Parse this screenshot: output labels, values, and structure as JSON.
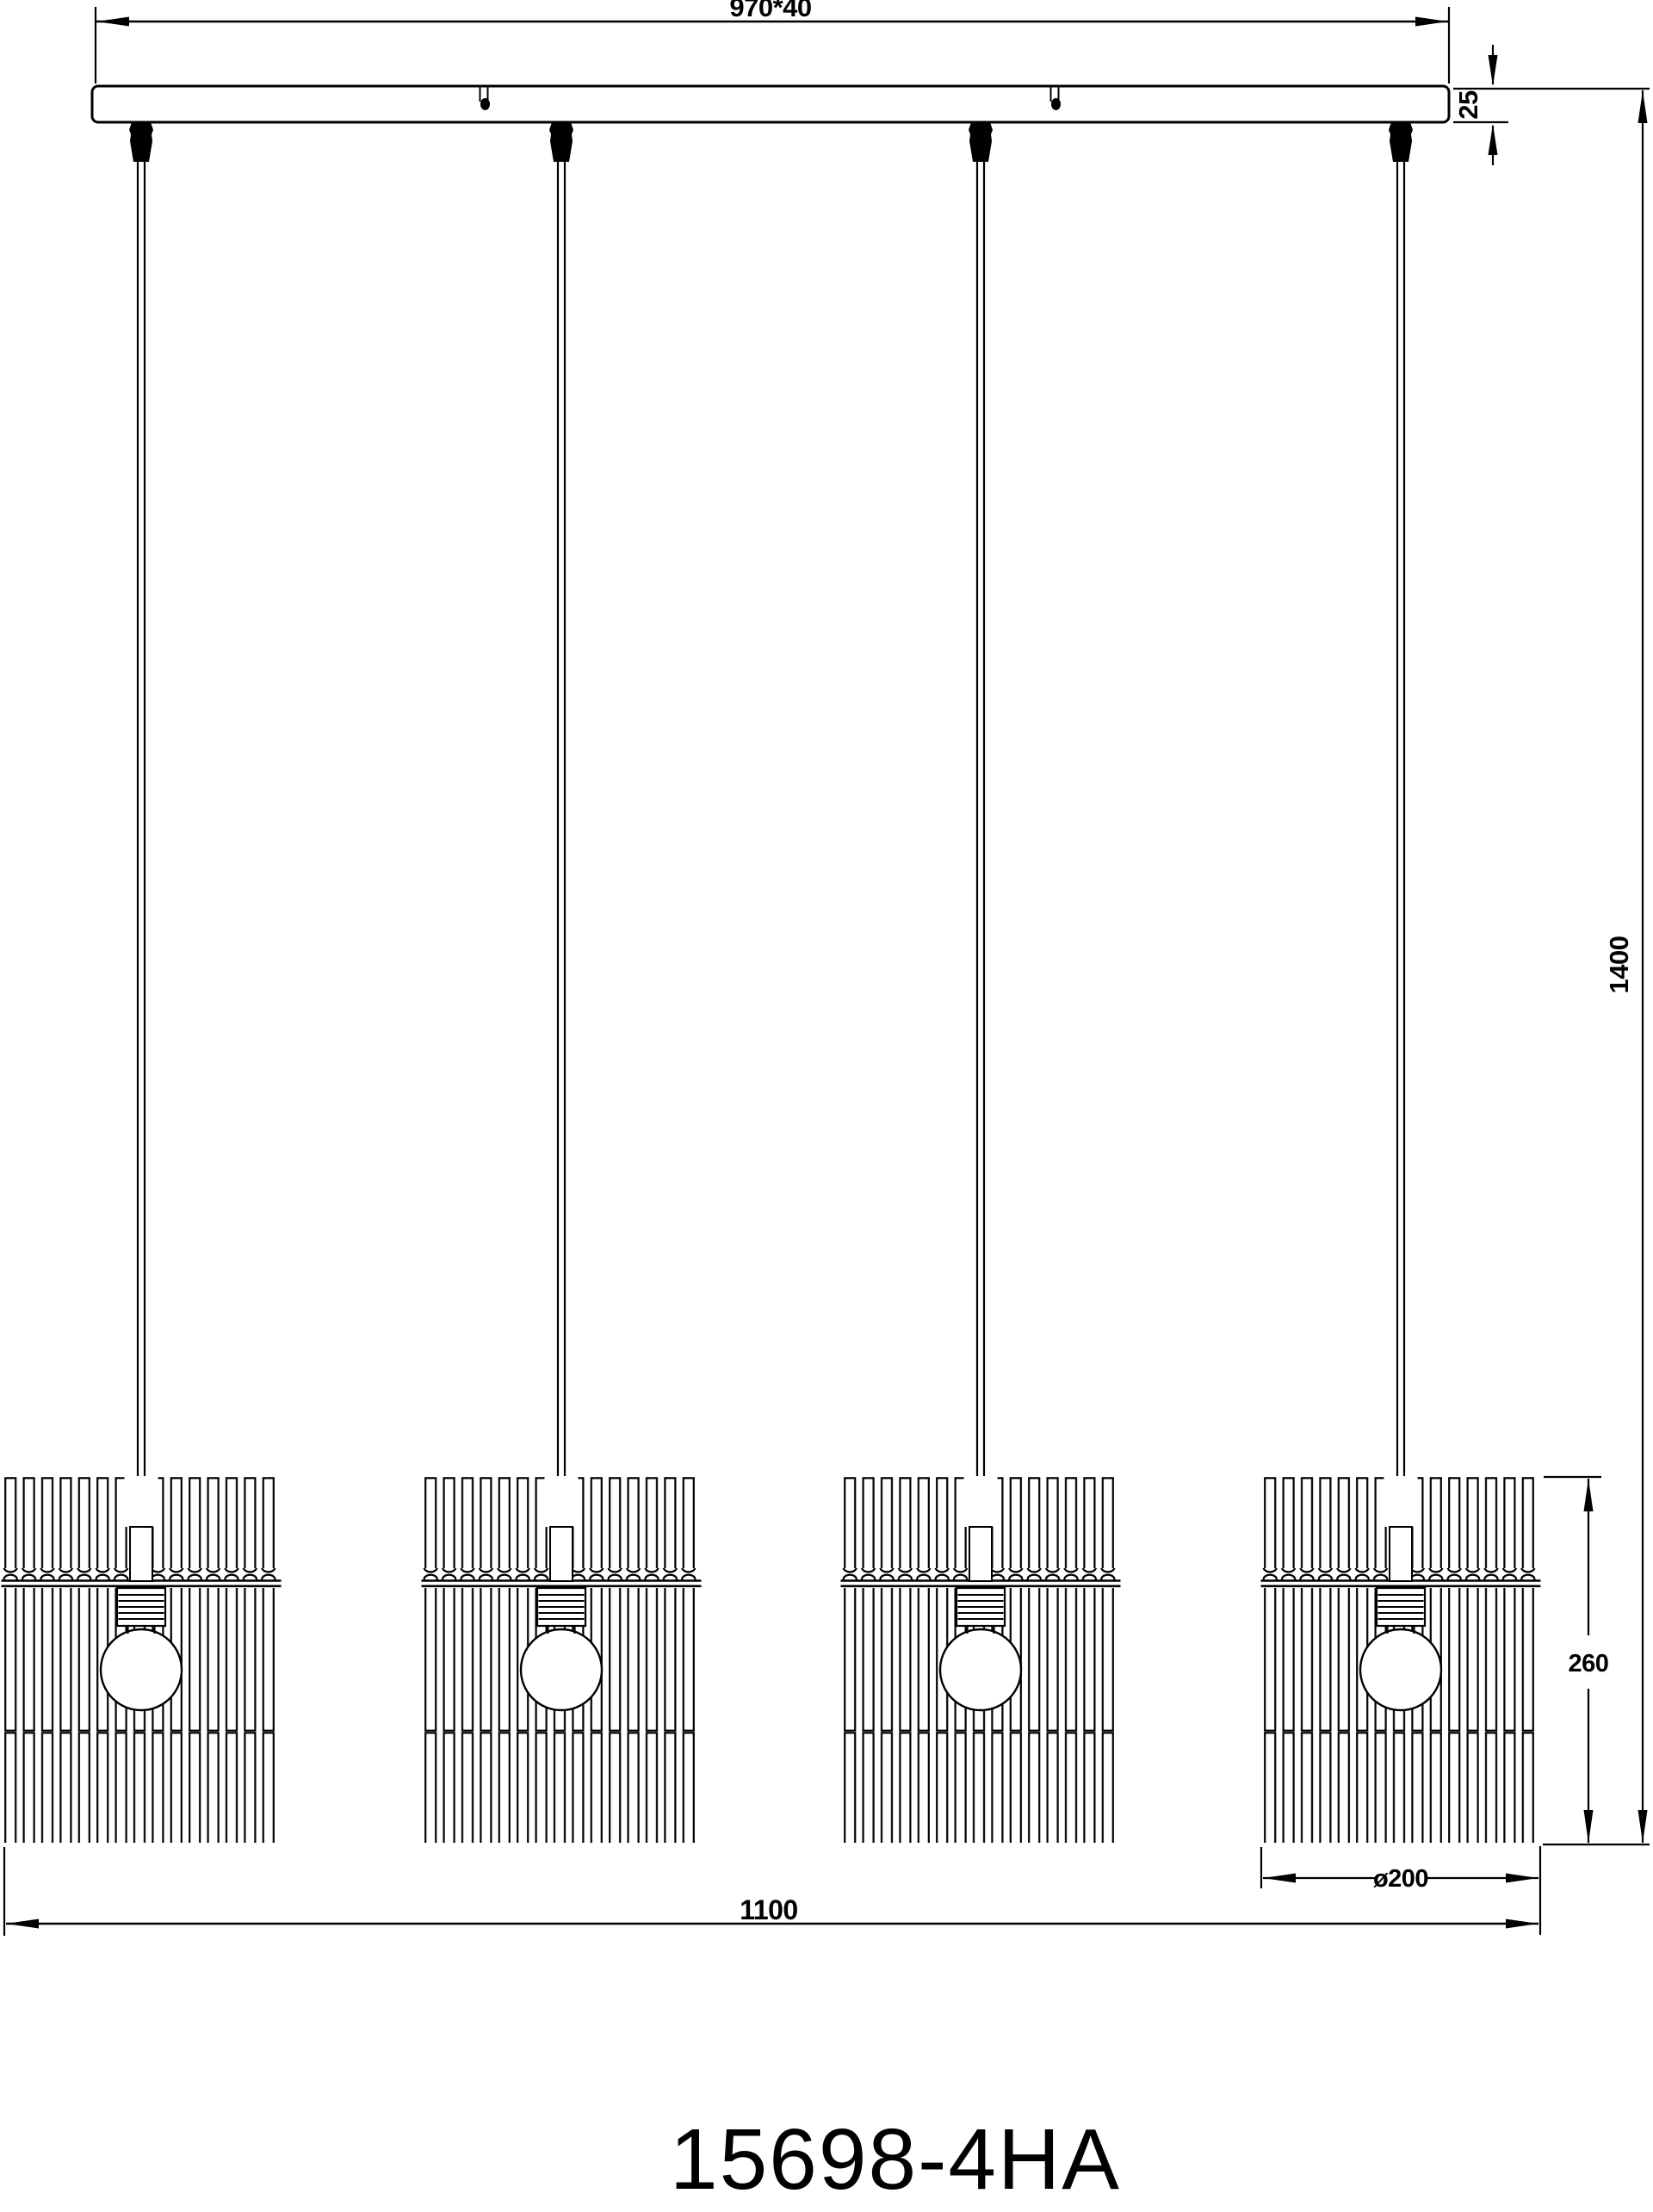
{
  "drawing": {
    "product_number": "15698-4HA",
    "pendant_count": 4,
    "dimensions": {
      "canopy_width": "970*40",
      "canopy_thickness": "25",
      "drop_height": "1400",
      "shade_height": "260",
      "shade_diameter": "ø200",
      "overall_width": "1100"
    },
    "colors": {
      "line": "#000000",
      "background": "#ffffff"
    }
  }
}
